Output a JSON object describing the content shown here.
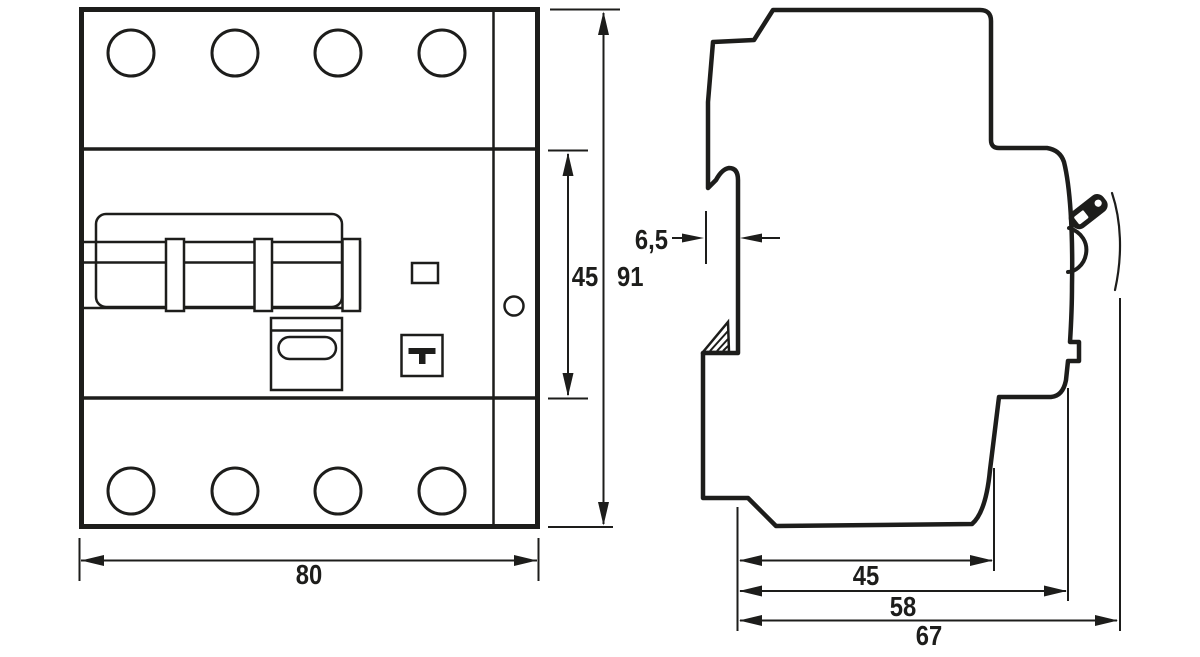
{
  "drawing": {
    "type": "technical_dimension_drawing",
    "subject": "4-pole DIN-rail circuit breaker, front and side views",
    "colors": {
      "line": "#1d1d1b",
      "background": "#ffffff"
    },
    "front_view": {
      "width_label": "80",
      "mid_height_label": "45",
      "total_height_label": "91"
    },
    "side_view": {
      "rail_offset_label": "6,5",
      "depth_to_rail_label": "45",
      "depth_body_label": "58",
      "depth_total_label": "67"
    }
  }
}
